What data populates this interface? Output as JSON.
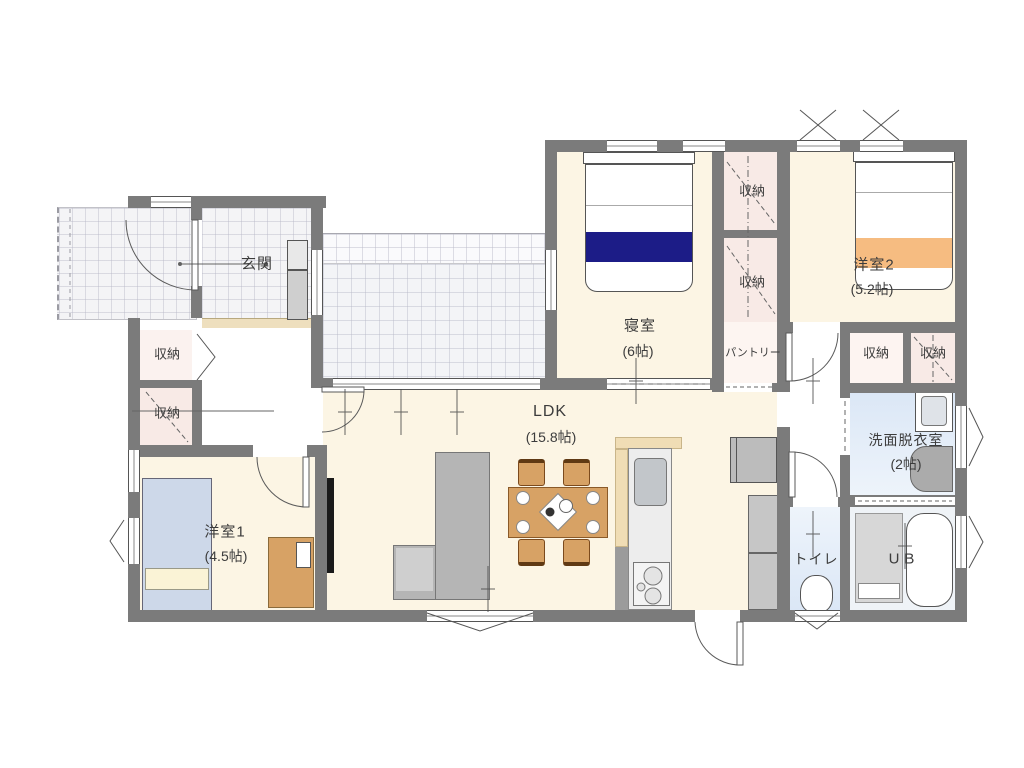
{
  "plan_title": "floor-plan",
  "rooms": {
    "genkan": {
      "label": "玄関"
    },
    "closet_hall_upper": {
      "label": "収納"
    },
    "closet_hall_lower": {
      "label": "収納"
    },
    "youshitsu1": {
      "label": "洋室1",
      "size": "(4.5帖)"
    },
    "ldk": {
      "label": "LDK",
      "size": "(15.8帖)"
    },
    "shinshitsu": {
      "label": "寝室",
      "size": "(6帖)"
    },
    "closet_bed_upper": {
      "label": "収納"
    },
    "closet_bed_lower": {
      "label": "収納"
    },
    "youshitsu2": {
      "label": "洋室2",
      "size": "(5.2帖)"
    },
    "pantry": {
      "label": "パントリー"
    },
    "closet_right_1": {
      "label": "収納"
    },
    "closet_right_2": {
      "label": "収納"
    },
    "senmen": {
      "label": "洗面脱衣室",
      "size": "(2帖)"
    },
    "toilet": {
      "label": "トイレ"
    },
    "ub": {
      "label": "UB"
    }
  },
  "colors": {
    "wall": "#7b7b7b",
    "label": "#3c3c3c",
    "floor": "#fcf5e4",
    "tile": "#f4f4f6",
    "kamachi": "#eedfbe",
    "closetPink": "#f8eae6",
    "closetLight": "#fbf2ef",
    "wetBlue": "#dbe7f6",
    "wetLight": "#eef4fb",
    "bedNavy": "#1c1c87",
    "bedOrange": "#f6bc81",
    "bedBlue": "#cdd8e9",
    "pillowCream": "#faf3d6",
    "wood": "#d7a265",
    "woodDark": "#8a5a28",
    "sofaGray": "#b5b5b5",
    "sofaLightGray": "#cfcfcf",
    "applianceGray": "#bcbcbc",
    "kitchenBody": "#ededed",
    "sinkGray": "#c2c6ca",
    "tvBlack": "#1a1a1a"
  }
}
